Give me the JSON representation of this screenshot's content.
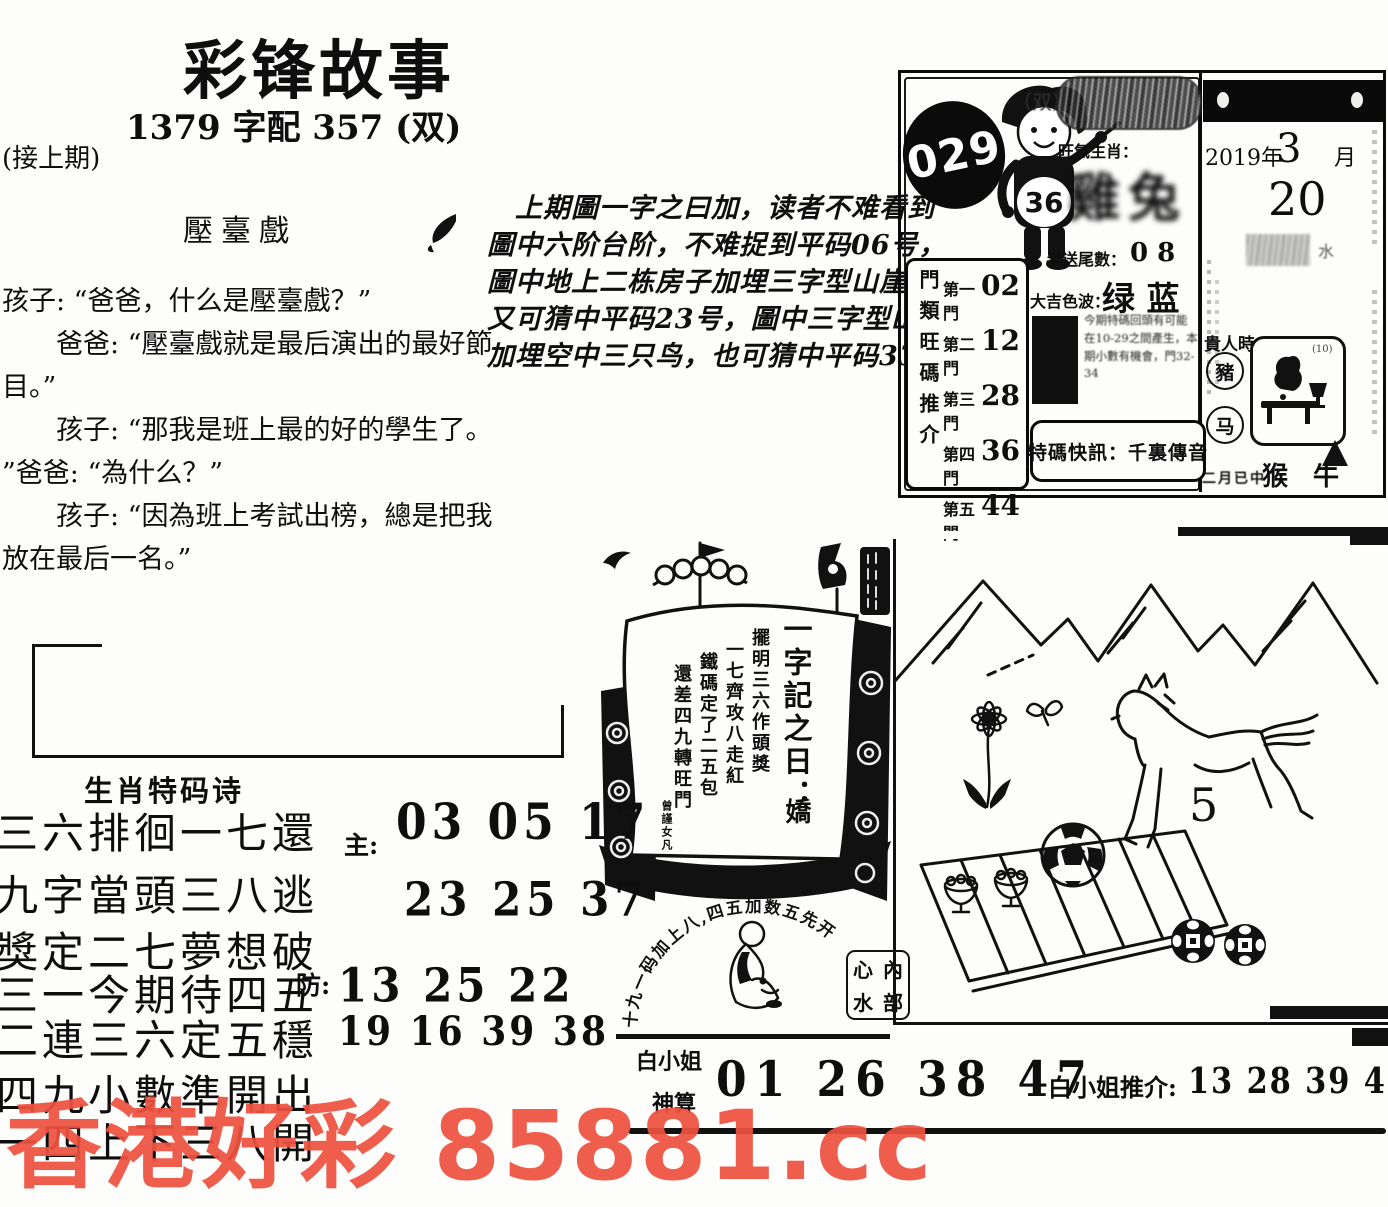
{
  "watermark": {
    "text": "香港好彩 85881.cc",
    "color": "#ee5140"
  },
  "header": {
    "title": "彩锋故事",
    "subtitle": "1379 字配 357 (双)",
    "continued": "(接上期)"
  },
  "story": {
    "title": "壓臺戲",
    "lines": [
      "孩子: “爸爸，什么是壓臺戲？”",
      "　　爸爸: “壓臺戲就是最后演出的最好節",
      "目。”",
      "　　孩子: “那我是班上最的好的學生了。",
      "”爸爸: “為什么？”",
      "　　孩子: “因為班上考試出榜，總是把我",
      "放在最后一名。”"
    ]
  },
  "analysis": {
    "lines": [
      "上期圖一字之曰加，读者不难看到",
      "圖中六阶台阶，不难捉到平码06号，",
      "圖中地上二栋房子加埋三字型山崖，",
      "又可猜中平码23号，圖中三字型山崖",
      "加埋空中三只鸟，也可猜中平码33号。"
    ]
  },
  "panel": {
    "issue": "029",
    "boy_number": "36",
    "double_mark": "（双）",
    "zodiac_label": "旺氣生肖：",
    "zodiac_art": "雞兔",
    "tail_label": "半送尾數：",
    "tail_value": "0 8",
    "color_label": "大吉色波：",
    "color_value": "绿 蓝",
    "gate_header": "門類旺碼推介",
    "gates": [
      {
        "label": "第一門",
        "num": "02"
      },
      {
        "label": "第二門",
        "num": "12"
      },
      {
        "label": "第三門",
        "num": "28"
      },
      {
        "label": "第四門",
        "num": "36"
      },
      {
        "label": "第五門",
        "num": "44"
      }
    ],
    "notice": "今期特碼回頭有可能在10-29之間產生，本期小數有機會，門32-34",
    "special": "特碼快訊：千裏傳音",
    "calendar": {
      "year": "2019年",
      "month": "3",
      "month_unit": "月",
      "day": "20",
      "noble": "貴人時",
      "zodiac_a": "豬",
      "zodiac_b": "马",
      "pic_note": "(10)",
      "smudge": "水",
      "footer_script": "二月已中",
      "footer_animals": "猴 牛"
    }
  },
  "ship": {
    "headline": "一字記之日：",
    "headline_char": "嬌",
    "columns": [
      "擺明三六作頭獎",
      "一七齊攻八走紅",
      "鐵碼定了二五包",
      "還差四九轉旺門"
    ],
    "signature": "曾謹女凡",
    "arc_text": "十九一码加上八,四五加数五先开",
    "stamp": [
      "心",
      "內",
      "水",
      "部"
    ]
  },
  "scene": {
    "horse_number": "5"
  },
  "poem": {
    "header": "生肖特码诗",
    "verses": [
      "三六排徊一七還",
      "九字當頭三八逃",
      "獎定二七夢想破",
      "三一今期待四五",
      "二連三六定五穩",
      "四九小數準開出",
      "一四上下三八開"
    ],
    "zhu_label": "主:",
    "zhu_numbers": "03 05 17",
    "row2_numbers": "23 25 37",
    "fang_label": "防:",
    "fang_numbers": "13 25 22",
    "row4_numbers": "19 16 39 38"
  },
  "bottom": {
    "lady_line1": "白小姐",
    "lady_line2": "神算",
    "main_numbers": "01 26 38 47",
    "rec_label": "白小姐推介:",
    "rec_numbers": "13 28 39 41 46"
  }
}
